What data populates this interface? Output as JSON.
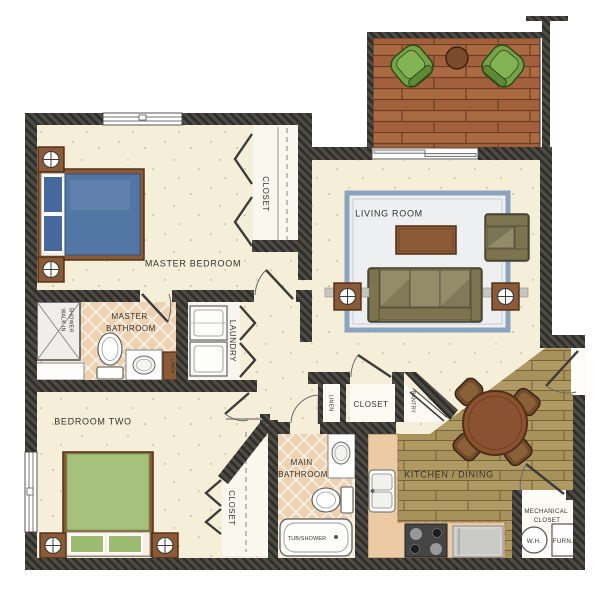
{
  "labels": {
    "master_bedroom": "MASTER BEDROOM",
    "master_closet": "CLOSET",
    "living_room": "LIVING ROOM",
    "laundry": "LAUNDRY",
    "master_bathroom": [
      "MASTER",
      "BATHROOM"
    ],
    "walk_in_shower": [
      "WALK IN",
      "SHOWER"
    ],
    "master_linen": "LINEN",
    "bedroom_two": "BEDROOM TWO",
    "bedroom_two_closet": "CLOSET",
    "main_bathroom": [
      "MAIN",
      "BATHROOM"
    ],
    "tub_shower": "TUB/SHOWER",
    "hall_linen": "LINEN",
    "hall_closet": "CLOSET",
    "pantry": "PANTRY",
    "kitchen_dining": "KITCHEN / DINING",
    "mechanical_closet": [
      "MECHANICAL",
      "CLOSET"
    ],
    "water_heater": "W.H.",
    "furnace": "FURN."
  },
  "colors": {
    "wall": "#3e3c38",
    "floor_cream": "#f5efda",
    "deck_wood": "#a2613c",
    "kitchen_wood": "#a8925c",
    "bath_tile": "#ecd2b3",
    "counter_tan": "#eccaa3",
    "rug_border": "#8ba4bd",
    "rug_field": "#edeff0",
    "sofa_olive": "#8a8464",
    "table_brown": "#8b5a36",
    "master_bed_blue": "#5377a5",
    "bedroom_two_green": "#a5c17c",
    "deck_chair_green": "#74a348"
  }
}
